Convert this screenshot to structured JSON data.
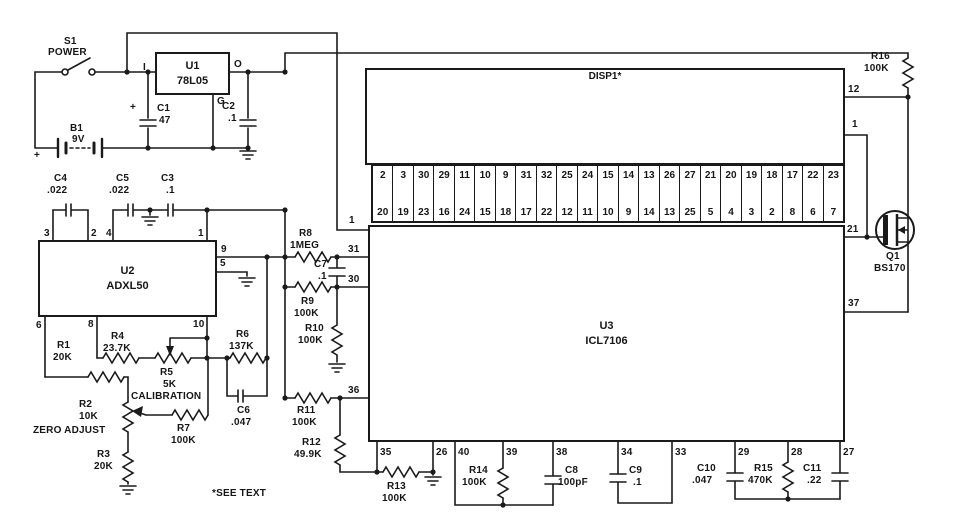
{
  "display": {
    "ref": "DISP1*",
    "reading": "18.88",
    "pin12": "12",
    "pin1": "1"
  },
  "pins": {
    "top": [
      "2",
      "3",
      "30",
      "29",
      "11",
      "10",
      "9",
      "31",
      "32",
      "25",
      "24",
      "15",
      "14",
      "13",
      "26",
      "27",
      "21",
      "20",
      "19",
      "18",
      "17",
      "22",
      "23"
    ],
    "bottom": [
      "20",
      "19",
      "23",
      "16",
      "24",
      "15",
      "18",
      "17",
      "22",
      "12",
      "11",
      "10",
      "9",
      "14",
      "13",
      "25",
      "5",
      "4",
      "3",
      "2",
      "8",
      "6",
      "7"
    ]
  },
  "power": {
    "s1": {
      "ref": "S1",
      "label": "POWER"
    },
    "b1": {
      "ref": "B1",
      "value": "9V",
      "plus": "+"
    },
    "u1": {
      "ref": "U1",
      "value": "78L05",
      "in": "I",
      "out": "O",
      "gnd": "G"
    },
    "c1": {
      "ref": "C1",
      "value": "47",
      "plus": "+"
    },
    "c2": {
      "ref": "C2",
      "value": ".1"
    }
  },
  "sensor": {
    "u2": {
      "ref": "U2",
      "value": "ADXL50",
      "pin3": "3",
      "pin2": "2",
      "pin4": "4",
      "pin1": "1",
      "pin9": "9",
      "pin5": "5",
      "pin6": "6",
      "pin8": "8",
      "pin10": "10"
    },
    "c4": {
      "ref": "C4",
      "value": ".022"
    },
    "c5": {
      "ref": "C5",
      "value": ".022"
    },
    "c3": {
      "ref": "C3",
      "value": ".1"
    },
    "r1": {
      "ref": "R1",
      "value": "20K"
    },
    "r2": {
      "ref": "R2",
      "value": "10K",
      "label": "ZERO ADJUST"
    },
    "r3": {
      "ref": "R3",
      "value": "20K"
    },
    "r4": {
      "ref": "R4",
      "value": "23.7K"
    },
    "r5": {
      "ref": "R5",
      "value": "5K",
      "label": "CALIBRATION"
    },
    "r6": {
      "ref": "R6",
      "value": "137K"
    },
    "r7": {
      "ref": "R7",
      "value": "100K"
    },
    "c6": {
      "ref": "C6",
      "value": ".047"
    }
  },
  "adc": {
    "u3": {
      "ref": "U3",
      "value": "ICL7106",
      "pin1": "1",
      "pin31": "31",
      "pin30": "30",
      "pin36": "36",
      "pin35": "35",
      "pin26": "26",
      "pin40": "40",
      "pin39": "39",
      "pin38": "38",
      "pin34": "34",
      "pin33": "33",
      "pin29": "29",
      "pin28": "28",
      "pin27": "27",
      "pin21": "21",
      "pin37": "37"
    },
    "r8": {
      "ref": "R8",
      "value": "1MEG"
    },
    "c7": {
      "ref": "C7",
      "value": ".1"
    },
    "r9": {
      "ref": "R9",
      "value": "100K"
    },
    "r10": {
      "ref": "R10",
      "value": "100K"
    },
    "r11": {
      "ref": "R11",
      "value": "100K"
    },
    "r12": {
      "ref": "R12",
      "value": "49.9K"
    },
    "r13": {
      "ref": "R13",
      "value": "100K"
    },
    "r14": {
      "ref": "R14",
      "value": "100K"
    },
    "c8": {
      "ref": "C8",
      "value": "100pF"
    },
    "c9": {
      "ref": "C9",
      "value": ".1"
    },
    "c10": {
      "ref": "C10",
      "value": ".047"
    },
    "r15": {
      "ref": "R15",
      "value": "470K"
    },
    "c11": {
      "ref": "C11",
      "value": ".22"
    }
  },
  "output": {
    "r16": {
      "ref": "R16",
      "value": "100K"
    },
    "q1": {
      "ref": "Q1",
      "value": "BS170"
    }
  },
  "note": "*SEE TEXT"
}
